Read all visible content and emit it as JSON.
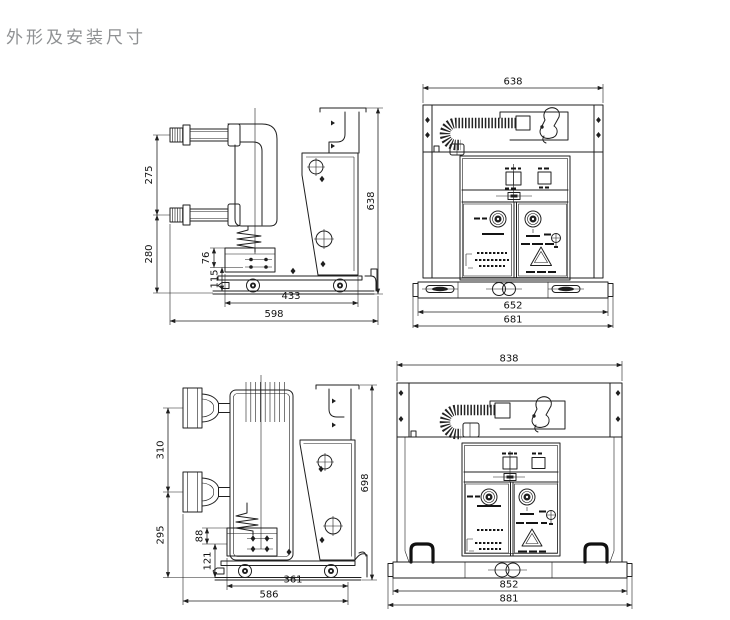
{
  "page": {
    "title": "外形及安装尺寸",
    "background": "#ffffff",
    "line_color": "#1f1f1f",
    "title_color": "#8f9193"
  },
  "symbols": {
    "warning_triangle": "double-outline triangle",
    "position_marker": "filled diamond",
    "target_hole": "circle with crosshair",
    "wheel": "circle with filled hub"
  },
  "drawings": {
    "side_top": {
      "dims": {
        "v275": "275",
        "v280": "280",
        "v76": "76",
        "v115": "115",
        "v433": "433",
        "v598": "598",
        "v638": "638"
      }
    },
    "front_top": {
      "dims": {
        "v638": "638",
        "v652": "652",
        "v681": "681"
      }
    },
    "side_bottom": {
      "dims": {
        "v310": "310",
        "v295": "295",
        "v88": "88",
        "v121": "121",
        "v361": "361",
        "v586": "586",
        "v698": "698"
      }
    },
    "front_bottom": {
      "dims": {
        "v838": "838",
        "v852": "852",
        "v881": "881"
      }
    }
  }
}
